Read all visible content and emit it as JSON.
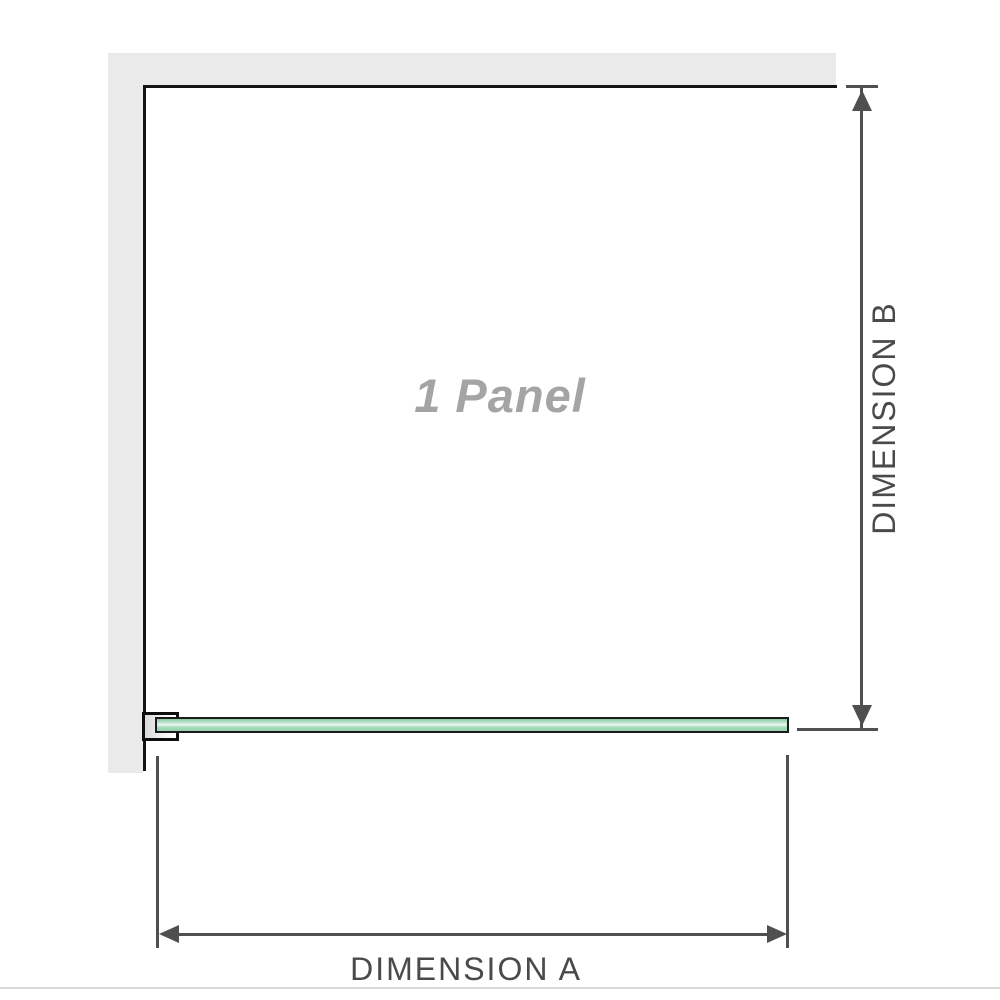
{
  "diagram": {
    "labels": {
      "panel": "1 Panel",
      "dimension_a": "DIMENSION A",
      "dimension_b": "DIMENSION B"
    },
    "colors": {
      "wall": "#eaeaea",
      "outline": "#141414",
      "bracket_outline": "#0d0d0d",
      "glass_green": "#96d1ae",
      "glass_highlight": "#eaf7ef",
      "dimension_line": "#4f4f4f",
      "dimension_text": "#4a4a4a",
      "watermark_text": "#a4a4a4",
      "separator": "#dadada"
    }
  }
}
